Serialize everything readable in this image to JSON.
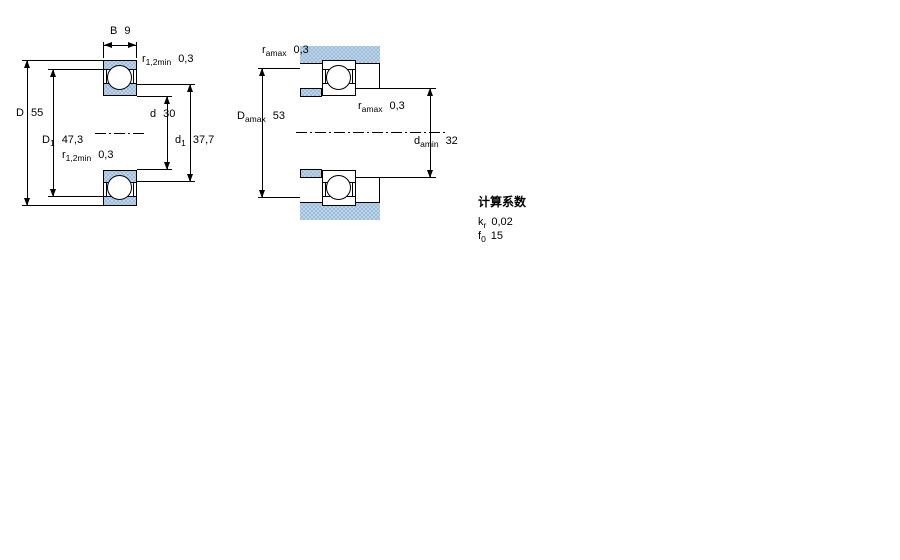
{
  "figure_left": {
    "labels": {
      "B": {
        "base": "B",
        "sub": "",
        "value": "9"
      },
      "r_top": {
        "base": "r",
        "sub": "1,2min",
        "value": "0,3"
      },
      "D": {
        "base": "D",
        "sub": "",
        "value": "55"
      },
      "D1": {
        "base": "D",
        "sub": "1",
        "value": "47,3"
      },
      "r_mid": {
        "base": "r",
        "sub": "1,2min",
        "value": "0,3"
      },
      "d": {
        "base": "d",
        "sub": "",
        "value": "30"
      },
      "d1": {
        "base": "d",
        "sub": "1",
        "value": "37,7"
      }
    }
  },
  "figure_right": {
    "labels": {
      "r_a_top": {
        "base": "r",
        "sub": "amax",
        "value": "0,3"
      },
      "D_a": {
        "base": "D",
        "sub": "amax",
        "value": "53"
      },
      "r_a_mid": {
        "base": "r",
        "sub": "amax",
        "value": "0,3"
      },
      "d_a": {
        "base": "d",
        "sub": "amin",
        "value": "32"
      }
    }
  },
  "calculation_factors": {
    "title": "计算系数",
    "rows": [
      {
        "base": "k",
        "sub": "r",
        "value": "0,02"
      },
      {
        "base": "f",
        "sub": "0",
        "value": "15"
      }
    ]
  },
  "colors": {
    "line": "#000000",
    "fill_blue": "#bcd3e9",
    "fill_blue_dot": "#8fb2d4",
    "background": "#ffffff"
  }
}
